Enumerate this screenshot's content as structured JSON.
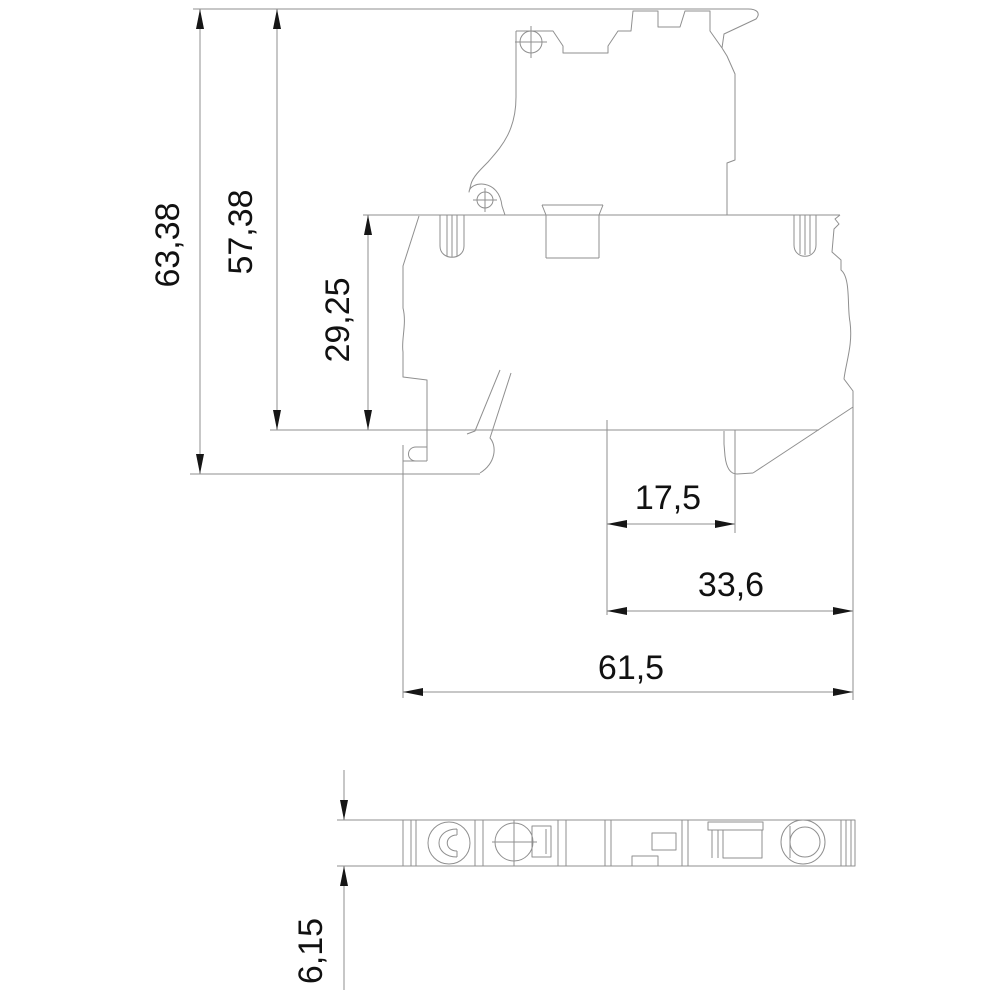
{
  "drawing": {
    "type": "technical-dimension-drawing",
    "background_color": "#ffffff",
    "line_color": "#8f8f8f",
    "arrow_color": "#161616",
    "text_color": "#111111",
    "decimal_style": "comma",
    "views": {
      "side_view": "terminal-block-side-profile",
      "bottom_view": "terminal-block-bottom-footprint"
    }
  },
  "dimensions": {
    "overall_height": {
      "label": "63,38",
      "orientation": "vertical"
    },
    "upper_height": {
      "label": "57,38",
      "orientation": "vertical"
    },
    "body_height": {
      "label": "29,25",
      "orientation": "vertical"
    },
    "hook_offset": {
      "label": "17,5",
      "orientation": "horizontal"
    },
    "rear_depth": {
      "label": "33,6",
      "orientation": "horizontal"
    },
    "overall_depth": {
      "label": "61,5",
      "orientation": "horizontal"
    },
    "module_width": {
      "label": "6,15",
      "orientation": "vertical"
    }
  }
}
